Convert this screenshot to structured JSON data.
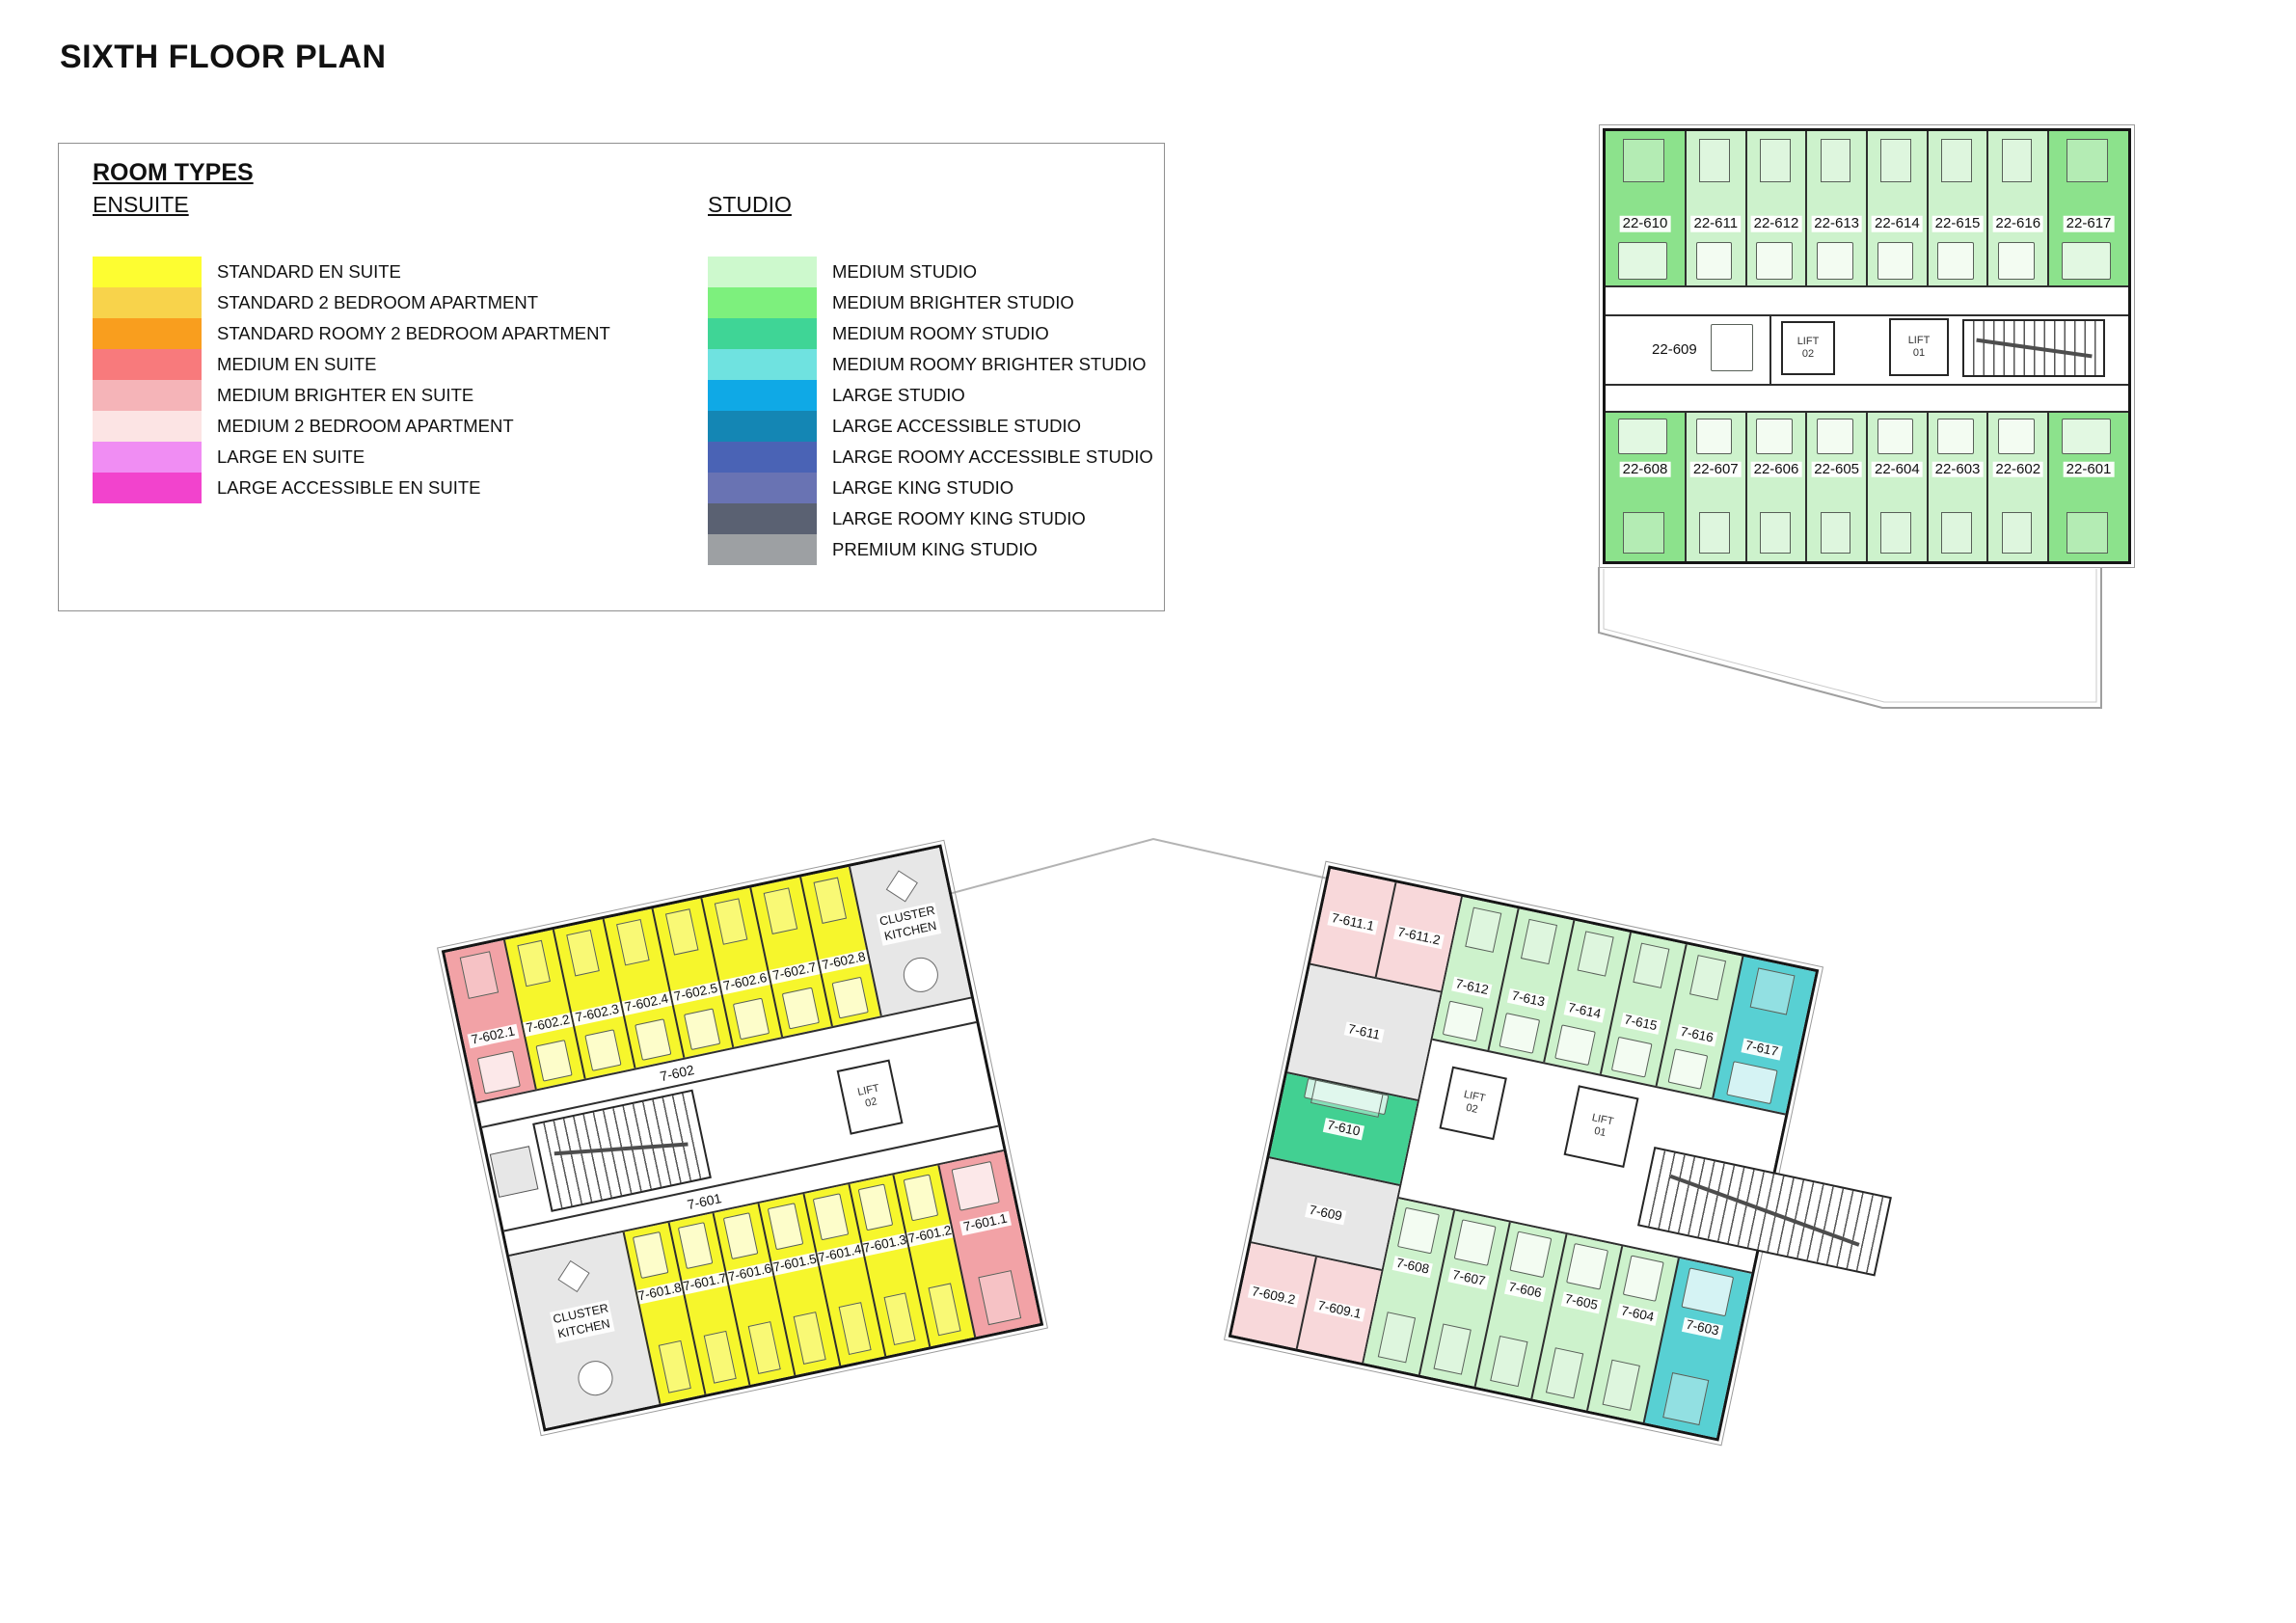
{
  "title": "SIXTH FLOOR PLAN",
  "legend": {
    "heading": "ROOM TYPES",
    "columns": [
      {
        "heading": "ENSUITE",
        "items": [
          {
            "label": "STANDARD EN SUITE",
            "color": "#fdfd31"
          },
          {
            "label": "STANDARD 2 BEDROOM APARTMENT",
            "color": "#f8d34b"
          },
          {
            "label": "STANDARD ROOMY 2 BEDROOM APARTMENT",
            "color": "#f99e1e"
          },
          {
            "label": "MEDIUM EN SUITE",
            "color": "#f87a7c"
          },
          {
            "label": "MEDIUM BRIGHTER EN SUITE",
            "color": "#f5b4b8"
          },
          {
            "label": "MEDIUM 2 BEDROOM APARTMENT",
            "color": "#fce4e4"
          },
          {
            "label": "LARGE EN SUITE",
            "color": "#f08df3"
          },
          {
            "label": "LARGE ACCESSIBLE EN SUITE",
            "color": "#f243cd"
          }
        ]
      },
      {
        "heading": "STUDIO",
        "items": [
          {
            "label": "MEDIUM STUDIO",
            "color": "#cdf9cd"
          },
          {
            "label": "MEDIUM BRIGHTER STUDIO",
            "color": "#7df07d"
          },
          {
            "label": "MEDIUM ROOMY STUDIO",
            "color": "#3fd596"
          },
          {
            "label": "MEDIUM ROOMY BRIGHTER STUDIO",
            "color": "#6fe2e0"
          },
          {
            "label": "LARGE STUDIO",
            "color": "#0fa9e6"
          },
          {
            "label": "LARGE ACCESSIBLE STUDIO",
            "color": "#1486b4"
          },
          {
            "label": "LARGE ROOMY ACCESSIBLE STUDIO",
            "color": "#4a63b5"
          },
          {
            "label": "LARGE  KING STUDIO",
            "color": "#6973b3"
          },
          {
            "label": "LARGE ROOMY KING STUDIO",
            "color": "#5a6172"
          },
          {
            "label": "PREMIUM KING STUDIO",
            "color": "#9da0a3"
          }
        ]
      }
    ]
  },
  "palette": {
    "standard_en_suite": "#f6f62c",
    "medium_brighter_en_suite": "#f2a2a6",
    "medium_2bed": "#f8d8da",
    "medium_studio": "#cdf2cc",
    "medium_brighter_studio": "#8ce28c",
    "medium_roomy_studio": "#42d092",
    "medium_roomy_brighter_studio": "#58d0d3",
    "large_king_studio": "#7e86c2",
    "apartment_common": "#e7e7e7"
  },
  "kitchen_label_lines": [
    "CLUSTER",
    "KITCHEN"
  ],
  "plan22": {
    "top_row": [
      {
        "id": "22-610",
        "type": "medium_brighter_studio"
      },
      {
        "id": "22-611",
        "type": "medium_studio"
      },
      {
        "id": "22-612",
        "type": "medium_studio"
      },
      {
        "id": "22-613",
        "type": "medium_studio"
      },
      {
        "id": "22-614",
        "type": "medium_studio"
      },
      {
        "id": "22-615",
        "type": "medium_studio"
      },
      {
        "id": "22-616",
        "type": "medium_studio"
      },
      {
        "id": "22-617",
        "type": "medium_brighter_studio"
      }
    ],
    "king_room": {
      "id": "22-609",
      "type": "large_king_studio"
    },
    "lifts": [
      {
        "line1": "LIFT",
        "line2": "02"
      },
      {
        "line1": "LIFT",
        "line2": "01"
      }
    ],
    "bottom_row": [
      {
        "id": "22-608",
        "type": "medium_brighter_studio"
      },
      {
        "id": "22-607",
        "type": "medium_studio"
      },
      {
        "id": "22-606",
        "type": "medium_studio"
      },
      {
        "id": "22-605",
        "type": "medium_studio"
      },
      {
        "id": "22-604",
        "type": "medium_studio"
      },
      {
        "id": "22-603",
        "type": "medium_studio"
      },
      {
        "id": "22-602",
        "type": "medium_studio"
      },
      {
        "id": "22-601",
        "type": "medium_brighter_studio"
      }
    ]
  },
  "planL": {
    "corridors": [
      "7-602",
      "7-601"
    ],
    "lift": {
      "line1": "LIFT",
      "line2": "02"
    },
    "top_row": [
      {
        "id": "7-602.1",
        "type": "medium_brighter_en_suite"
      },
      {
        "id": "7-602.2",
        "type": "standard_en_suite"
      },
      {
        "id": "7-602.3",
        "type": "standard_en_suite"
      },
      {
        "id": "7-602.4",
        "type": "standard_en_suite"
      },
      {
        "id": "7-602.5",
        "type": "standard_en_suite"
      },
      {
        "id": "7-602.6",
        "type": "standard_en_suite"
      },
      {
        "id": "7-602.7",
        "type": "standard_en_suite"
      },
      {
        "id": "7-602.8",
        "type": "standard_en_suite"
      },
      {
        "kitchen": true
      }
    ],
    "bottom_row": [
      {
        "kitchen": true
      },
      {
        "id": "7-601.8",
        "type": "standard_en_suite"
      },
      {
        "id": "7-601.7",
        "type": "standard_en_suite"
      },
      {
        "id": "7-601.6",
        "type": "standard_en_suite"
      },
      {
        "id": "7-601.5",
        "type": "standard_en_suite"
      },
      {
        "id": "7-601.4",
        "type": "standard_en_suite"
      },
      {
        "id": "7-601.3",
        "type": "standard_en_suite"
      },
      {
        "id": "7-601.2",
        "type": "standard_en_suite"
      },
      {
        "id": "7-601.1",
        "type": "medium_brighter_en_suite"
      }
    ]
  },
  "planR": {
    "lifts": [
      {
        "line1": "LIFT",
        "line2": "02"
      },
      {
        "line1": "LIFT",
        "line2": "01"
      }
    ],
    "left_col_rows": [
      {
        "cells": [
          {
            "id": "7-611.1",
            "type": "medium_2bed"
          },
          {
            "id": "7-611.2",
            "type": "medium_2bed"
          }
        ]
      },
      {
        "cells": [
          {
            "id": "7-611",
            "type": "apartment_common"
          }
        ]
      },
      {
        "cells": [
          {
            "id": "7-610",
            "type": "medium_roomy_studio"
          }
        ]
      },
      {
        "cells": [
          {
            "id": "7-609",
            "type": "apartment_common"
          }
        ]
      },
      {
        "cells": [
          {
            "id": "7-609.2",
            "type": "medium_2bed"
          },
          {
            "id": "7-609.1",
            "type": "medium_2bed"
          }
        ]
      }
    ],
    "top_row": [
      {
        "id": "7-612",
        "type": "medium_studio"
      },
      {
        "id": "7-613",
        "type": "medium_studio"
      },
      {
        "id": "7-614",
        "type": "medium_studio"
      },
      {
        "id": "7-615",
        "type": "medium_studio"
      },
      {
        "id": "7-616",
        "type": "medium_studio"
      },
      {
        "id": "7-617",
        "type": "medium_roomy_brighter_studio"
      }
    ],
    "bottom_row": [
      {
        "id": "7-608",
        "type": "medium_studio"
      },
      {
        "id": "7-607",
        "type": "medium_studio"
      },
      {
        "id": "7-606",
        "type": "medium_studio"
      },
      {
        "id": "7-605",
        "type": "medium_studio"
      },
      {
        "id": "7-604",
        "type": "medium_studio"
      },
      {
        "id": "7-603",
        "type": "medium_roomy_brighter_studio"
      }
    ]
  }
}
